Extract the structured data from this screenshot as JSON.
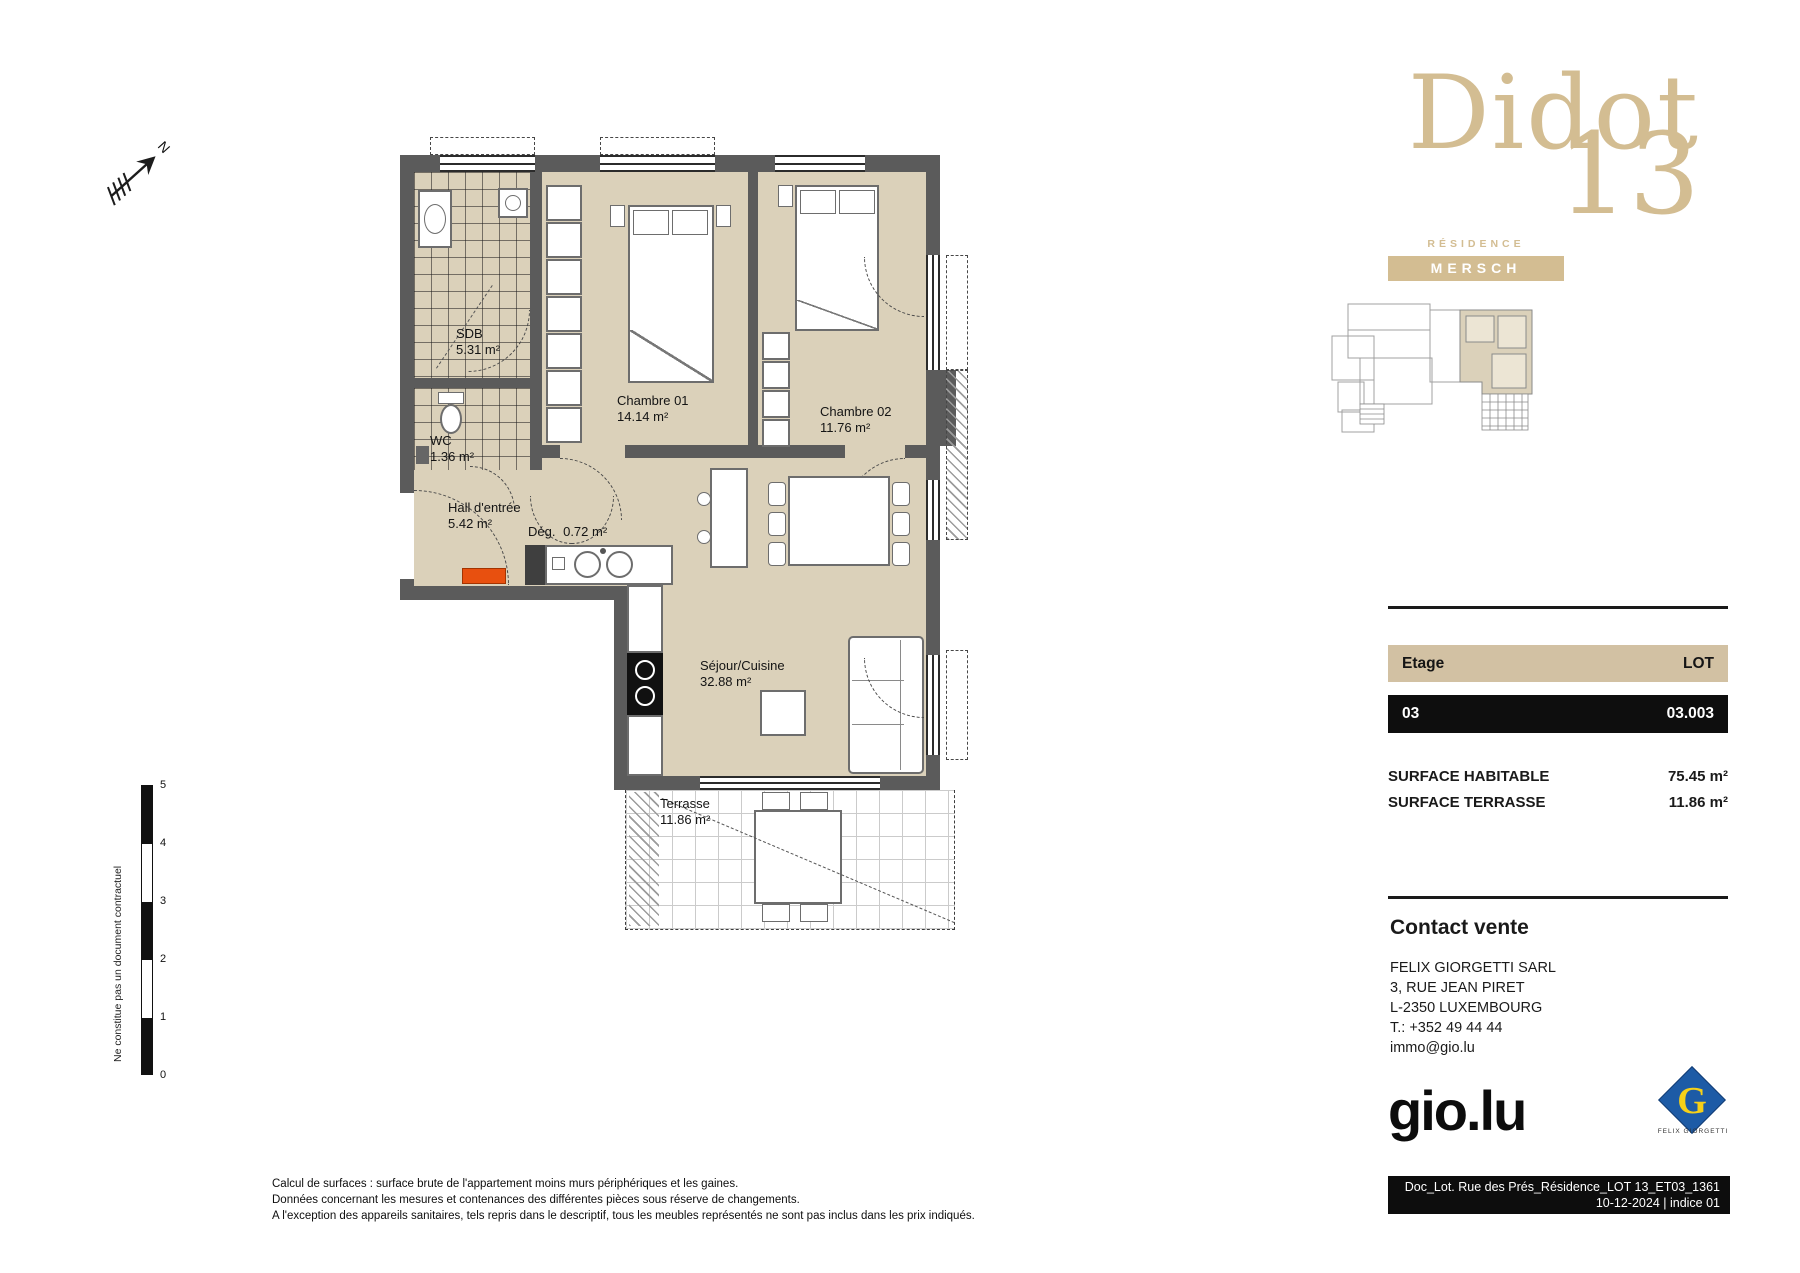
{
  "north": {
    "label": "N"
  },
  "brand": {
    "name": "Didot",
    "number": "13",
    "residence": "RÉSIDENCE",
    "city": "MERSCH"
  },
  "plan": {
    "rooms": [
      {
        "name": "SDB",
        "area": "5.31 m²"
      },
      {
        "name": "WC",
        "area": "1.36 m²"
      },
      {
        "name": "Chambre 01",
        "area": "14.14 m²"
      },
      {
        "name": "Chambre 02",
        "area": "11.76 m²"
      },
      {
        "name": "Hall d'entrée",
        "area": "5.42 m²"
      },
      {
        "name": "Dég.",
        "area": "0.72 m²"
      },
      {
        "name": "Séjour/Cuisine",
        "area": "32.88 m²"
      },
      {
        "name": "Terrasse",
        "area": "11.86 m²"
      }
    ]
  },
  "scale_bar": {
    "labels": [
      "5",
      "4",
      "3",
      "2",
      "1",
      "0"
    ]
  },
  "side_note": "Ne constitue pas un document contractuel",
  "info_table": {
    "col1_header": "Etage",
    "col2_header": "LOT",
    "col1_value": "03",
    "col2_value": "03.003"
  },
  "surfaces": {
    "habitable_label": "SURFACE HABITABLE",
    "habitable_value": "75.45 m²",
    "terrasse_label": "SURFACE TERRASSE",
    "terrasse_value": "11.86 m²"
  },
  "contact": {
    "title": "Contact vente",
    "company": "FELIX GIORGETTI SARL",
    "street": "3, RUE JEAN PIRET",
    "city": "L-2350 LUXEMBOURG",
    "phone": "T.: +352 49 44 44",
    "email": "immo@gio.lu"
  },
  "footer": {
    "gio_logo": "gio.lu",
    "giorgetti_letter": "G",
    "giorgetti_caption": "FELIX GIORGETTI",
    "doc_ref": "Doc_Lot. Rue des Prés_Résidence_LOT 13_ET03_1361",
    "doc_date": "10-12-2024 | indice 01"
  },
  "disclaimer": {
    "line1": "Calcul de surfaces : surface brute de l'appartement moins murs périphériques et les gaines.",
    "line2": "Données concernant les mesures et contenances des différentes pièces sous réserve de changements.",
    "line3": "A l'exception des appareils sanitaires, tels repris dans le descriptif, tous les meubles représentés ne sont pas inclus dans les prix indiqués."
  },
  "colors": {
    "brand_tan": "#d3bd92",
    "table_header_tan": "#d2c1a3",
    "wall_gray": "#5b5b5b",
    "floor_beige": "#dbd1ba",
    "accent_orange": "#e8500f",
    "logo_blue": "#1d5ba6",
    "logo_yellow": "#f6d018"
  }
}
